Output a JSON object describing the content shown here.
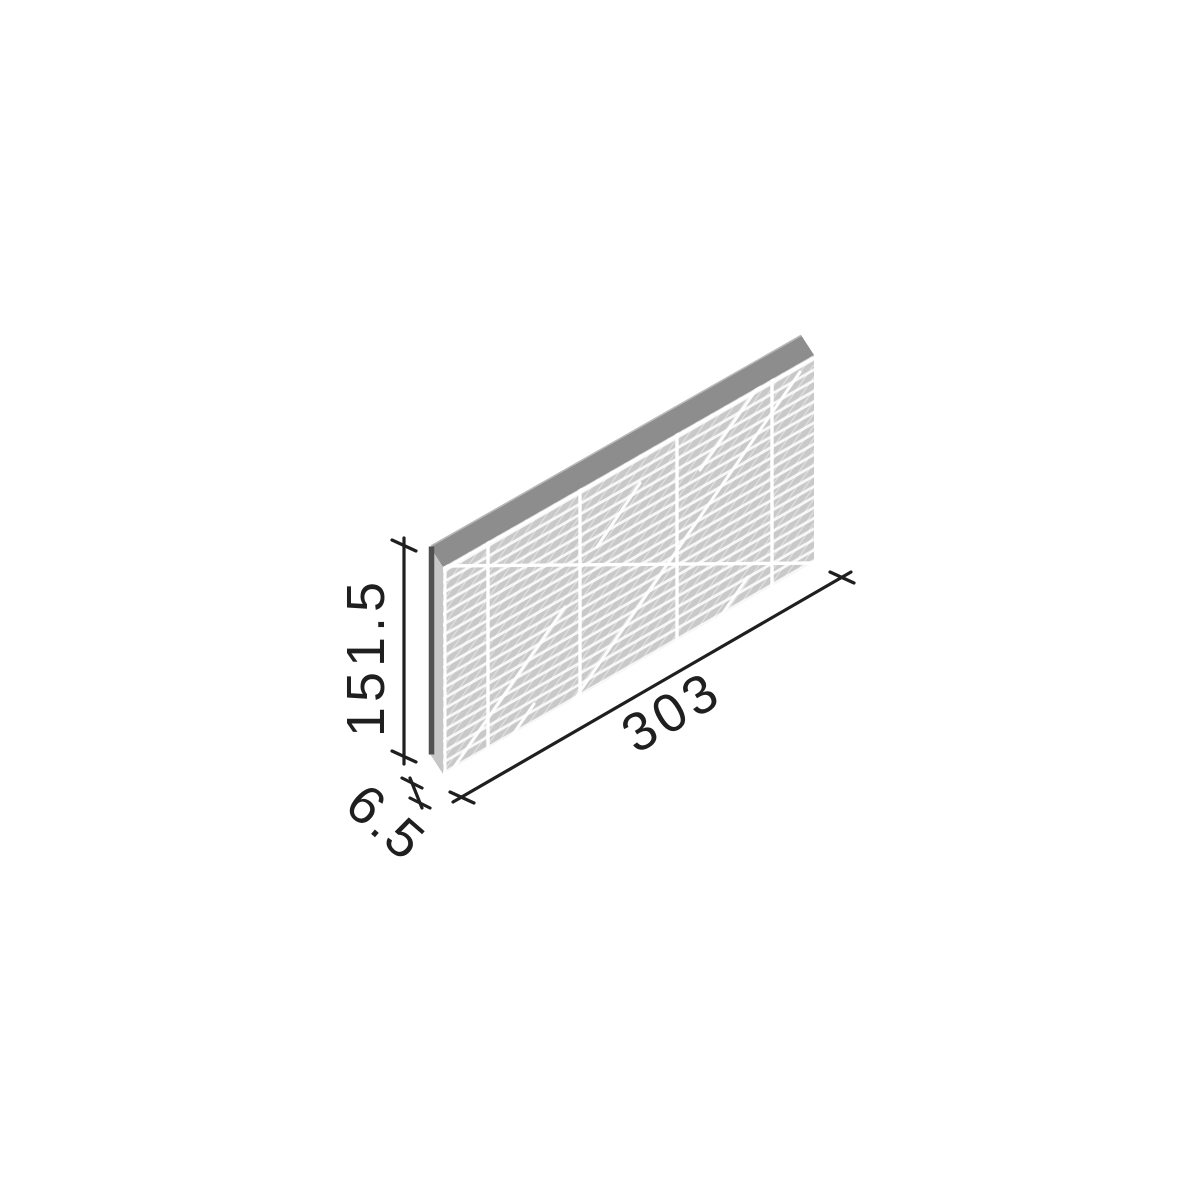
{
  "diagram": {
    "title": "tile-dimension-drawing",
    "subject": "Thin rectangular ribbed tile panel shown in isometric view with dimension lines (millimetres)",
    "dimensions": {
      "height": {
        "label": "151.5"
      },
      "width": {
        "label": "303"
      },
      "thickness": {
        "label": "6.5"
      }
    },
    "colors": {
      "background": "#ffffff",
      "dimension_line": "#1f1f1f",
      "label_text": "#1f1f1f",
      "tile_top_edge": "#8d8d8d",
      "tile_top_edge_highlight": "#b8b8b8",
      "tile_side_face": "#c6c6c6",
      "tile_left_edge_line": "#4f4f4f",
      "ridge_band": "#c9c9c9",
      "ridge_gap": "#f7f7f7",
      "joint_line": "#ffffff",
      "sheen_streak": "#ffffff"
    }
  }
}
